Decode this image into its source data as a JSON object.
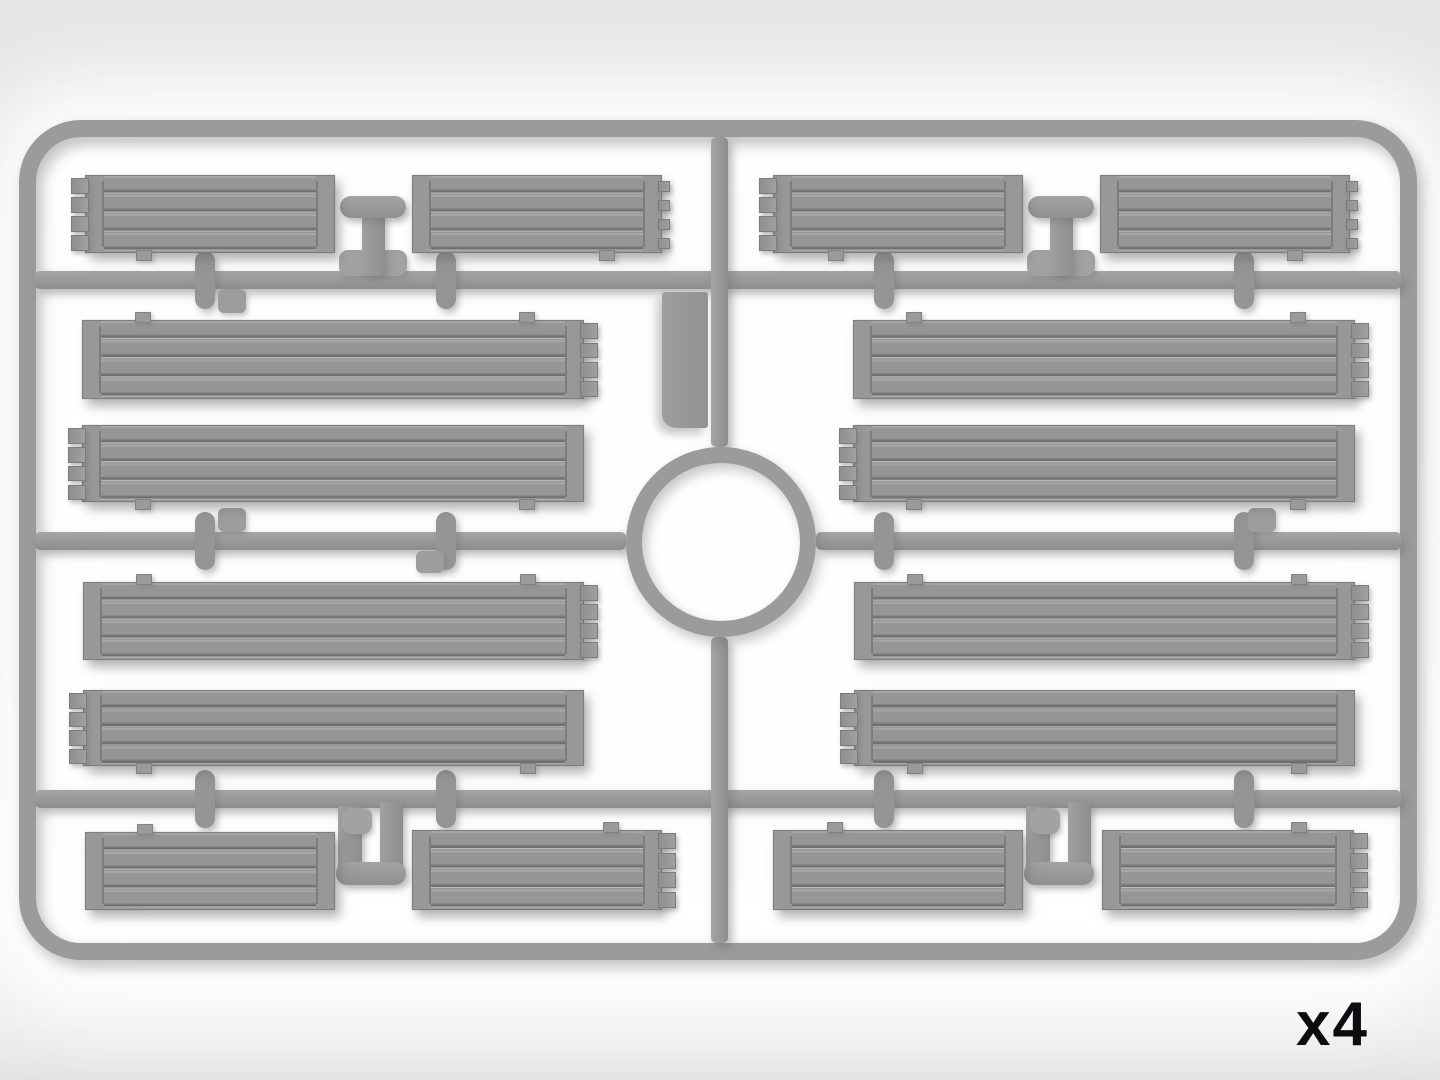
{
  "label": {
    "quantity": "x4"
  },
  "palette": {
    "background": "#e9e9e9",
    "plastic": "#9b9b9b",
    "plastic_shadow": "#6f6f6f",
    "plastic_highlight": "#a6a6a6",
    "label_color": "#0d0d11"
  },
  "sprue": {
    "frame": {
      "x": 19,
      "y": 120,
      "w": 1398,
      "h": 840,
      "thickness": 17,
      "radius": 62
    },
    "rails": [
      {
        "x": 35,
        "y": 271,
        "w": 1366,
        "h": 18,
        "dir": "h"
      },
      {
        "x": 35,
        "y": 532,
        "w": 591,
        "h": 18,
        "dir": "h"
      },
      {
        "x": 816,
        "y": 532,
        "w": 585,
        "h": 18,
        "dir": "h"
      },
      {
        "x": 35,
        "y": 790,
        "w": 1366,
        "h": 18,
        "dir": "h"
      },
      {
        "x": 711,
        "y": 137,
        "w": 17,
        "h": 310,
        "dir": "v"
      },
      {
        "x": 711,
        "y": 637,
        "w": 17,
        "h": 306,
        "dir": "v"
      }
    ],
    "ring": {
      "cx": 721,
      "cy": 542,
      "outer_r": 95,
      "thickness": 16
    },
    "top_connectors": [
      {
        "x": 340
      },
      {
        "x": 1028
      }
    ],
    "bottom_connectors": [
      {
        "x": 336
      },
      {
        "x": 1024
      }
    ],
    "stubs": [
      {
        "x": 205,
        "y": 280
      },
      {
        "x": 446,
        "y": 280
      },
      {
        "x": 884,
        "y": 280
      },
      {
        "x": 1244,
        "y": 280
      },
      {
        "x": 205,
        "y": 541
      },
      {
        "x": 446,
        "y": 541
      },
      {
        "x": 884,
        "y": 541
      },
      {
        "x": 1244,
        "y": 541
      },
      {
        "x": 205,
        "y": 799
      },
      {
        "x": 446,
        "y": 799
      },
      {
        "x": 884,
        "y": 799
      },
      {
        "x": 1244,
        "y": 799
      }
    ],
    "webs": [
      {
        "x": 218,
        "y": 289,
        "w": 28,
        "h": 24
      },
      {
        "x": 218,
        "y": 508,
        "w": 28,
        "h": 24
      },
      {
        "x": 416,
        "y": 551,
        "w": 28,
        "h": 22
      },
      {
        "x": 1248,
        "y": 508,
        "w": 28,
        "h": 24
      }
    ],
    "flat_tab": {
      "x": 662,
      "y": 292,
      "w": 46,
      "h": 136
    },
    "planks": [
      {
        "x": 85,
        "y": 175,
        "w": 248,
        "h": 76,
        "teeth": "left",
        "tabs": [
          {
            "edge": "bottom",
            "dx": 50
          }
        ]
      },
      {
        "x": 412,
        "y": 175,
        "w": 248,
        "h": 76,
        "teeth": "right-small",
        "tabs": [
          {
            "edge": "bottom",
            "dx": 186
          }
        ]
      },
      {
        "x": 82,
        "y": 320,
        "w": 500,
        "h": 77,
        "teeth": "right",
        "tabs": [
          {
            "edge": "top",
            "dx": 52
          },
          {
            "edge": "top",
            "dx": 436
          }
        ]
      },
      {
        "x": 82,
        "y": 425,
        "w": 500,
        "h": 75,
        "teeth": "left",
        "tabs": [
          {
            "edge": "bottom",
            "dx": 52
          },
          {
            "edge": "bottom",
            "dx": 436
          }
        ]
      },
      {
        "x": 83,
        "y": 582,
        "w": 499,
        "h": 76,
        "teeth": "right",
        "tabs": [
          {
            "edge": "top",
            "dx": 52
          },
          {
            "edge": "top",
            "dx": 436
          }
        ]
      },
      {
        "x": 83,
        "y": 690,
        "w": 499,
        "h": 74,
        "teeth": "left",
        "tabs": [
          {
            "edge": "bottom",
            "dx": 52
          },
          {
            "edge": "bottom",
            "dx": 436
          }
        ]
      },
      {
        "x": 85,
        "y": 832,
        "w": 248,
        "h": 76,
        "teeth": null,
        "tabs": [
          {
            "edge": "top",
            "dx": 51
          }
        ]
      },
      {
        "x": 412,
        "y": 830,
        "w": 248,
        "h": 78,
        "teeth": "right",
        "tabs": [
          {
            "edge": "top",
            "dx": 190
          }
        ]
      },
      {
        "x": 773,
        "y": 175,
        "w": 248,
        "h": 76,
        "teeth": "left",
        "tabs": [
          {
            "edge": "bottom",
            "dx": 54
          }
        ]
      },
      {
        "x": 1100,
        "y": 175,
        "w": 248,
        "h": 76,
        "teeth": "right-small",
        "tabs": [
          {
            "edge": "bottom",
            "dx": 186
          }
        ]
      },
      {
        "x": 853,
        "y": 320,
        "w": 500,
        "h": 77,
        "teeth": "right",
        "tabs": [
          {
            "edge": "top",
            "dx": 52
          },
          {
            "edge": "top",
            "dx": 436
          }
        ]
      },
      {
        "x": 853,
        "y": 425,
        "w": 500,
        "h": 75,
        "teeth": "left",
        "tabs": [
          {
            "edge": "bottom",
            "dx": 52
          },
          {
            "edge": "bottom",
            "dx": 436
          }
        ]
      },
      {
        "x": 854,
        "y": 582,
        "w": 499,
        "h": 76,
        "teeth": "right",
        "tabs": [
          {
            "edge": "top",
            "dx": 52
          },
          {
            "edge": "top",
            "dx": 436
          }
        ]
      },
      {
        "x": 854,
        "y": 690,
        "w": 499,
        "h": 74,
        "teeth": "left",
        "tabs": [
          {
            "edge": "bottom",
            "dx": 52
          },
          {
            "edge": "bottom",
            "dx": 436
          }
        ]
      },
      {
        "x": 773,
        "y": 830,
        "w": 248,
        "h": 78,
        "teeth": null,
        "tabs": [
          {
            "edge": "top",
            "dx": 53
          }
        ]
      },
      {
        "x": 1102,
        "y": 830,
        "w": 250,
        "h": 78,
        "teeth": "right",
        "tabs": [
          {
            "edge": "top",
            "dx": 188
          }
        ]
      }
    ]
  }
}
